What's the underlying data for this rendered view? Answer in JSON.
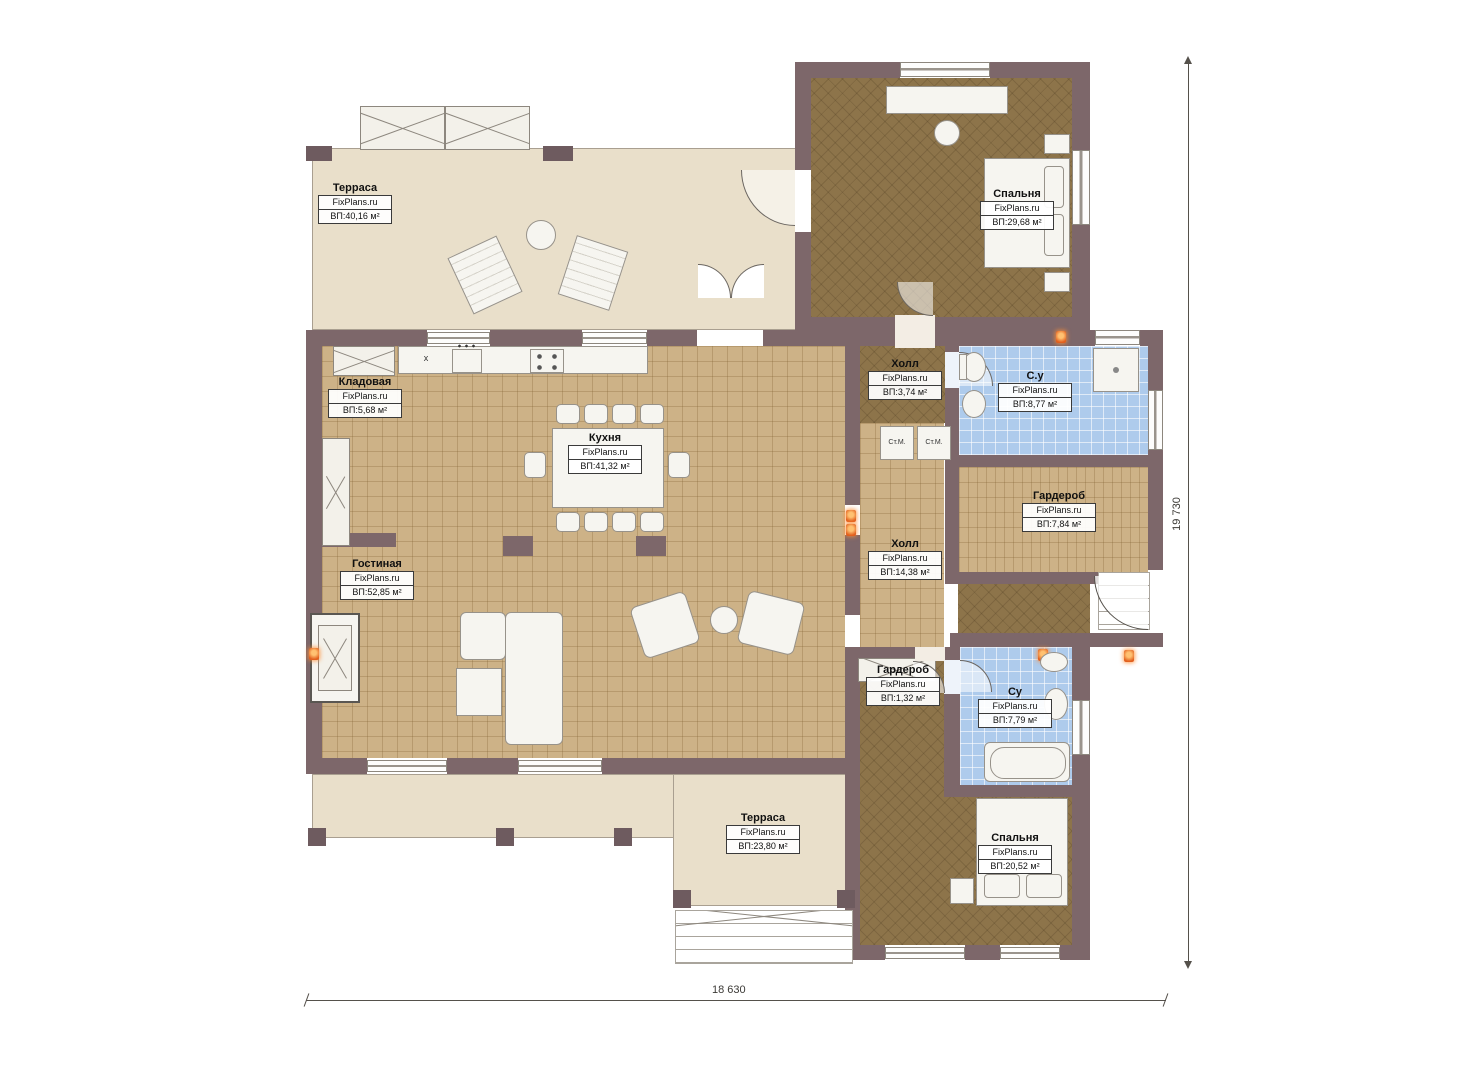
{
  "watermark": "FixPlans.ru",
  "rooms": {
    "terrace_top": {
      "title": "Терраса",
      "area": "ВП:40,16 м²"
    },
    "bedroom_top": {
      "title": "Спальня",
      "area": "ВП:29,68 м²"
    },
    "pantry": {
      "title": "Кладовая",
      "area": "ВП:5,68 м²"
    },
    "kitchen": {
      "title": "Кухня",
      "area": "ВП:41,32 м²"
    },
    "hall_small": {
      "title": "Холл",
      "area": "ВП:3,74 м²"
    },
    "bath_top": {
      "title": "С.у",
      "area": "ВП:8,77 м²"
    },
    "wardrobe_right": {
      "title": "Гардероб",
      "area": "ВП:7,84 м²"
    },
    "hall_main": {
      "title": "Холл",
      "area": "ВП:14,38 м²"
    },
    "living": {
      "title": "Гостиная",
      "area": "ВП:52,85 м²"
    },
    "wardrobe_small": {
      "title": "Гардероб",
      "area": "ВП:1,32 м²"
    },
    "bath_bottom": {
      "title": "Су",
      "area": "ВП:7,79 м²"
    },
    "terrace_bottom": {
      "title": "Терраса",
      "area": "ВП:23,80 м²"
    },
    "bedroom_bottom": {
      "title": "Спальня",
      "area": "ВП:20,52 м²"
    }
  },
  "fixtures": {
    "washer": "Ст.М.",
    "counter_mark": "x"
  },
  "dimensions": {
    "width": "18 630",
    "height": "19 730"
  },
  "palette": {
    "wall": "#7d676a",
    "floor_wood": "#cdb287",
    "floor_dark": "#8d744a",
    "bath": "#aecbec",
    "terrace": "#e9dfca",
    "accent": "#e2601e"
  }
}
